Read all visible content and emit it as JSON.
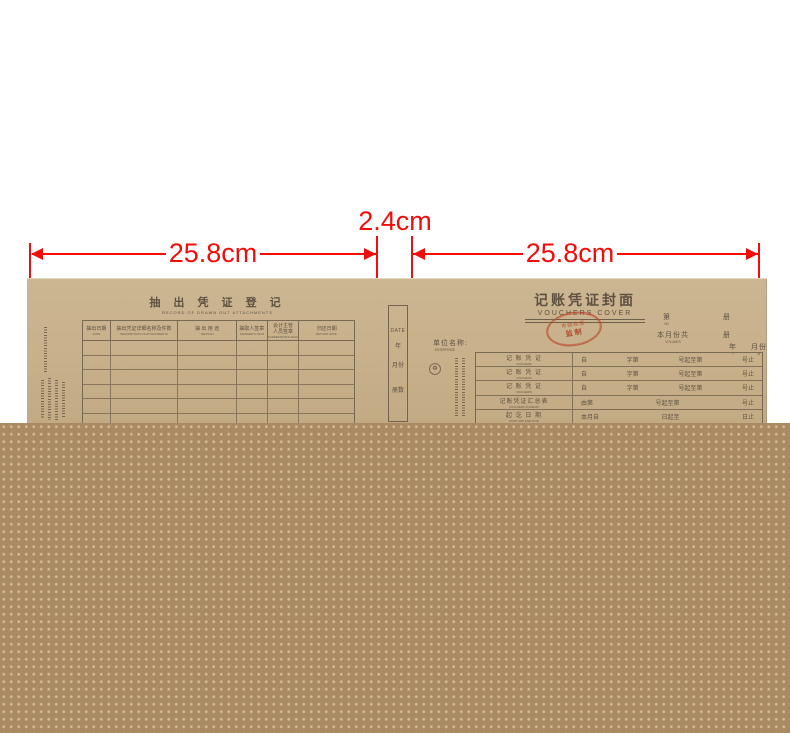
{
  "dimensions": {
    "left_width": "25.8cm",
    "spine_width": "2.4cm",
    "right_width": "25.8cm"
  },
  "colors": {
    "annotation_red": "#f20d0a",
    "paper_kraft": "#c7b08a",
    "ink_brown": "#5f5140",
    "stamp_red": "#b44a2e",
    "foreground_brown": "#a98a63"
  },
  "left_page": {
    "title_cn": "抽 出 凭 证 登 记",
    "title_en": "RECORD OF DRAWN OUT ATTACHMENTS",
    "columns": [
      {
        "cn": "抽出日期",
        "en": "DATE"
      },
      {
        "cn": "抽出凭证详细名称及件数",
        "en": "DESCRIPTION OF ATTACHMENTS"
      },
      {
        "cn": "抽 出 用 途",
        "en": "REASON"
      },
      {
        "cn": "抽取人签章",
        "en": "DRAWER'S SIGN"
      },
      {
        "cn": "会计主管\n人员签章",
        "en": "SUPERVISOR'S SIGN"
      },
      {
        "cn": "归还日期",
        "en": "RETURN DATE"
      }
    ],
    "empty_row_count": 6
  },
  "spine": {
    "date_label": "DATE",
    "vertical_labels": [
      "年",
      "月份",
      "册数"
    ]
  },
  "right_page": {
    "title_cn": "记账凭证封面",
    "title_en": "VOUCHERS COVER",
    "stamp": {
      "arc": "市财政局",
      "center": "监制"
    },
    "no_cn": "第",
    "no_en": "NO.",
    "no_unit": "册",
    "month_total_cn": "本月份共",
    "month_total_en": "VOLUMES",
    "month_total_unit": "册",
    "year_cn": "年",
    "year_en": "Y",
    "month_cn": "月份",
    "month_en": "M",
    "enterprise_cn": "单位名称:",
    "enterprise_en": "ENTERPRISE",
    "rows": [
      {
        "label_cn": "记 账 凭 证",
        "label_en": "VOUCHERS",
        "cells": [
          "自",
          "字第",
          "号起至第",
          "号止"
        ]
      },
      {
        "label_cn": "记 账 凭 证",
        "label_en": "VOUCHERS",
        "cells": [
          "自",
          "字第",
          "号起至第",
          "号止"
        ]
      },
      {
        "label_cn": "记 账 凭 证",
        "label_en": "VOUCHERS",
        "cells": [
          "自",
          "字第",
          "号起至第",
          "号止"
        ]
      },
      {
        "label_cn": "记账凭证汇总表",
        "label_en": "VOUCHERS SUMMARY",
        "cells": [
          "由第",
          "号起至第",
          "号止"
        ]
      },
      {
        "label_cn": "起 讫 日 期",
        "label_en": "START AND END DATE",
        "cells": [
          "本月自",
          "日起至",
          "日止"
        ]
      }
    ]
  }
}
